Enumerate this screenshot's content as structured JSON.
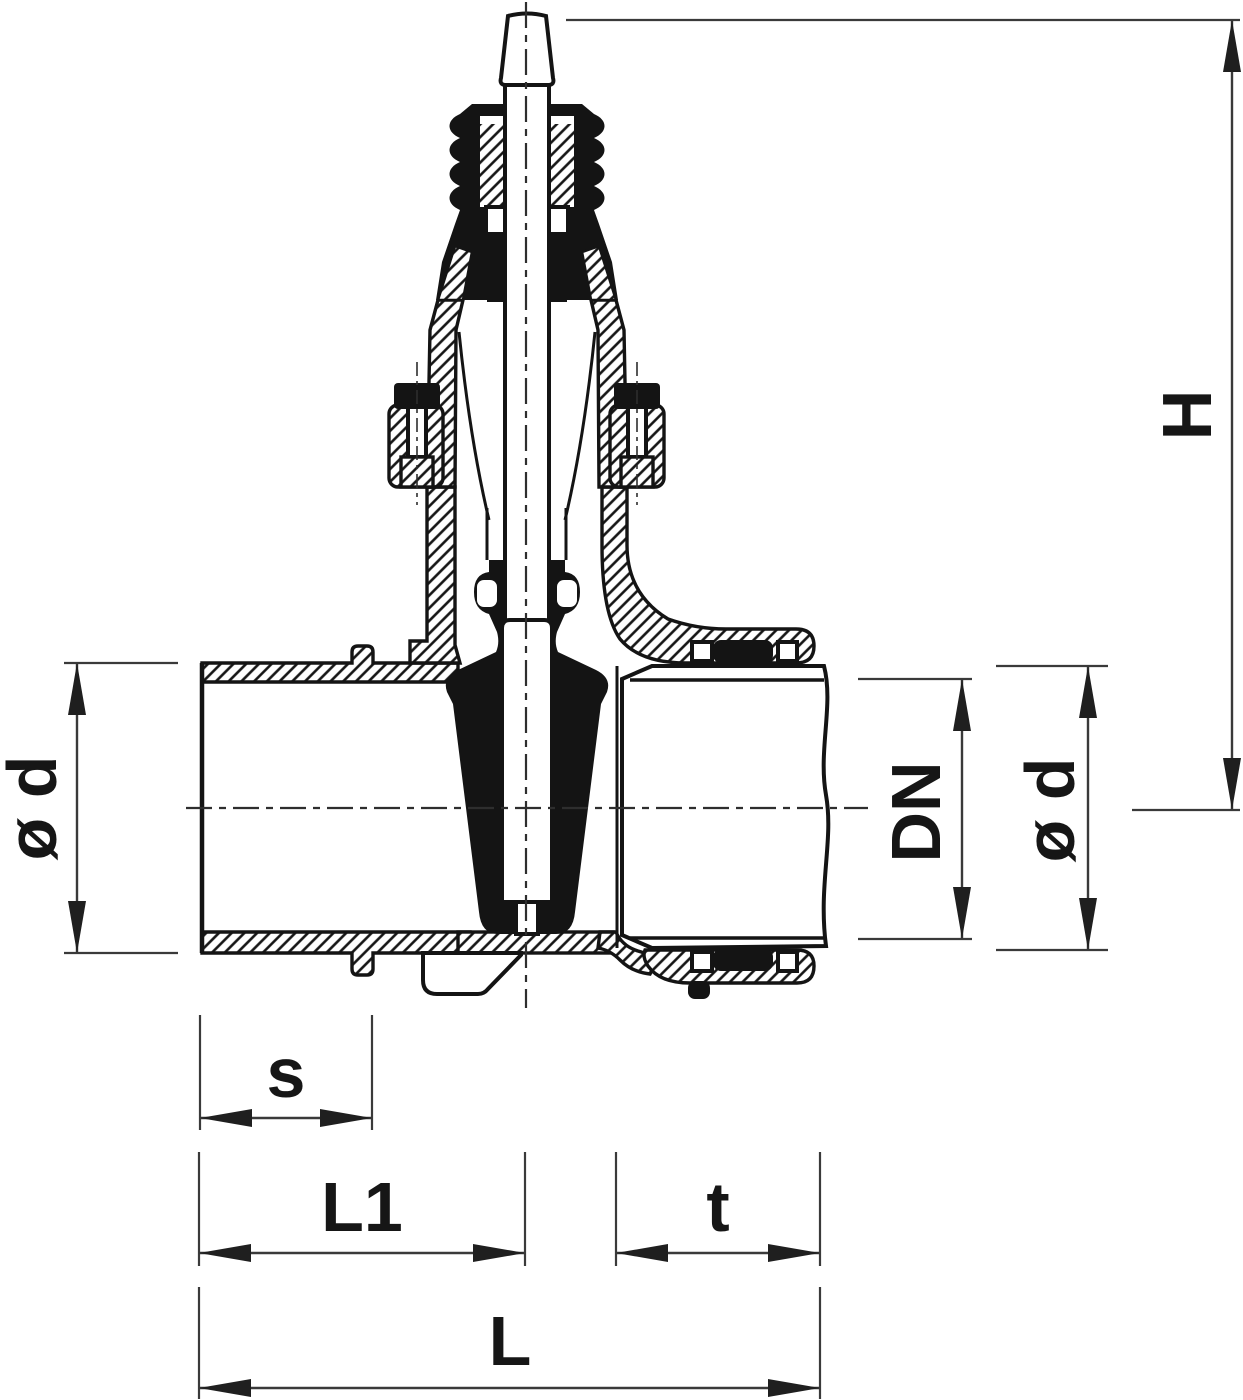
{
  "drawing": {
    "kind": "technical-cross-section",
    "subject": "gate valve with spigot and socket ends",
    "background_color": "#ffffff",
    "ink_color": "#141414",
    "dimension_line_color": "#3a3a3a"
  },
  "labels": {
    "height": "H",
    "outer_dia_left": "ø d",
    "nominal_dia": "DN",
    "outer_dia_right": "ø d",
    "spigot_wall": "s",
    "face_to_axis": "L1",
    "socket_depth": "t",
    "overall_length": "L"
  }
}
